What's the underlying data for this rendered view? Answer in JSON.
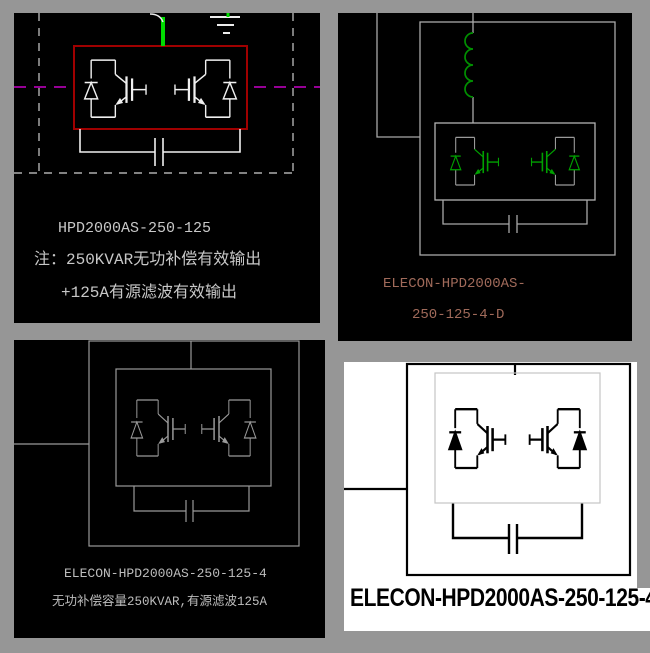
{
  "background_color": "#969696",
  "panels": {
    "top_left": {
      "background": "#000000",
      "line_color": "#f0f0f0",
      "module_box_color": "#a00000",
      "feed_line_color": "#00dc00",
      "phase_line_color": "#c800c8",
      "text_color": "#c8c8c8",
      "title": "HPD2000AS-250-125",
      "note1": "注：250KVAR无功补偿有效输出",
      "note2": "+125A有源滤波有效输出"
    },
    "top_right": {
      "background": "#000000",
      "line_color": "#a8a8a8",
      "component_color": "#00a000",
      "text_color": "#a06a5a",
      "model_line1": "ELECON-HPD2000AS-",
      "model_line2": "250-125-4-D"
    },
    "bottom_left": {
      "background": "#000000",
      "line_color": "#9a9a9a",
      "text_color": "#bdbdbd",
      "model": "ELECON-HPD2000AS-250-125-4",
      "note": "无功补偿容量250KVAR,有源滤波125A"
    },
    "bottom_right": {
      "background": "#ffffff",
      "line_color": "#000000",
      "inner_box_color": "#c4c4c4",
      "text_color": "#000000",
      "model": "ELECON-HPD2000AS-250-125-4"
    }
  }
}
